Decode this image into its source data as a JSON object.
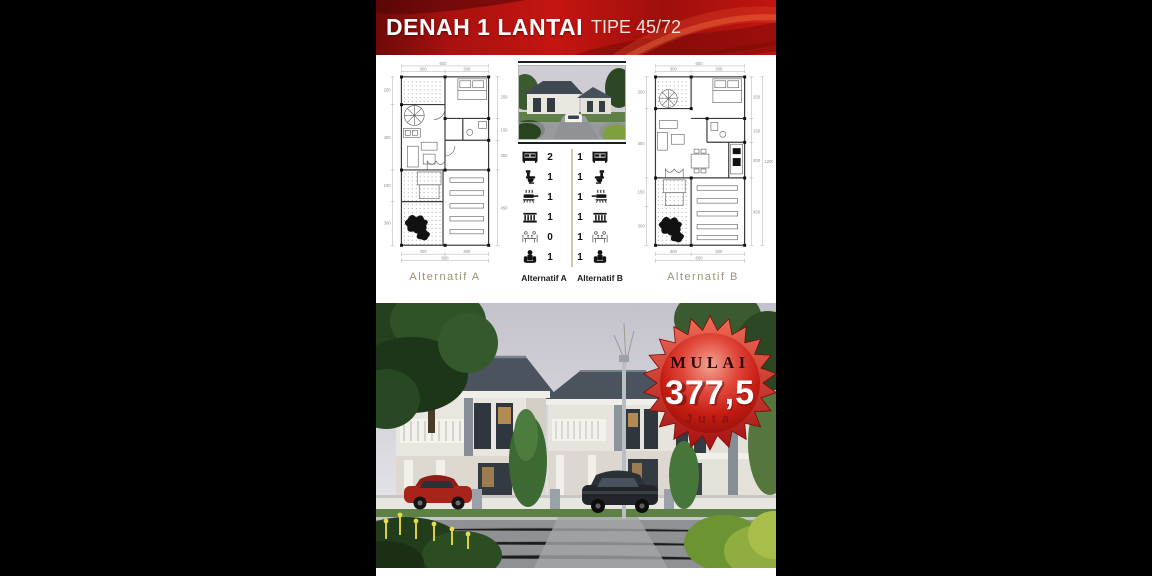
{
  "header": {
    "title": "DENAH 1 LANTAI",
    "subtitle": "TIPE 45/72"
  },
  "plans": {
    "a": {
      "label": "Alternatif  A",
      "dims": {
        "top_total": "600",
        "top_segments": [
          "300",
          "300"
        ],
        "bottom_segments": [
          "300",
          "300"
        ],
        "bottom_total": "600",
        "left": [
          "250",
          "450",
          "150",
          "300"
        ],
        "right": [
          "250",
          "150",
          "300",
          "450"
        ]
      }
    },
    "b": {
      "label": "Alternatif  B",
      "dims": {
        "top_total": "600",
        "top_segments": [
          "300",
          "300"
        ],
        "bottom_segments": [
          "300",
          "300"
        ],
        "bottom_total": "600",
        "left": [
          "250",
          "450",
          "150",
          "300"
        ],
        "right": [
          "250",
          "150",
          "300",
          "450"
        ],
        "side_total": "1200"
      }
    }
  },
  "comparison": {
    "label_a": "Alternatif A",
    "label_b": "Alternatif B",
    "rows": [
      {
        "icon": "bed-icon",
        "a": "2",
        "b": "1"
      },
      {
        "icon": "toilet-icon",
        "a": "1",
        "b": "1"
      },
      {
        "icon": "stove-icon",
        "a": "1",
        "b": "1"
      },
      {
        "icon": "railing-icon",
        "a": "1",
        "b": "1"
      },
      {
        "icon": "dining-table-icon",
        "a": "0",
        "b": "1"
      },
      {
        "icon": "armchair-icon",
        "a": "1",
        "b": "1"
      }
    ]
  },
  "price_badge": {
    "prefix": "MULAI",
    "amount": "377,5",
    "unit": "Juta"
  },
  "colors": {
    "header_red": "#c2140f",
    "badge_red": "#c61d13",
    "label_tan": "#9b9176",
    "divider_olive": "#cfc9a8"
  }
}
